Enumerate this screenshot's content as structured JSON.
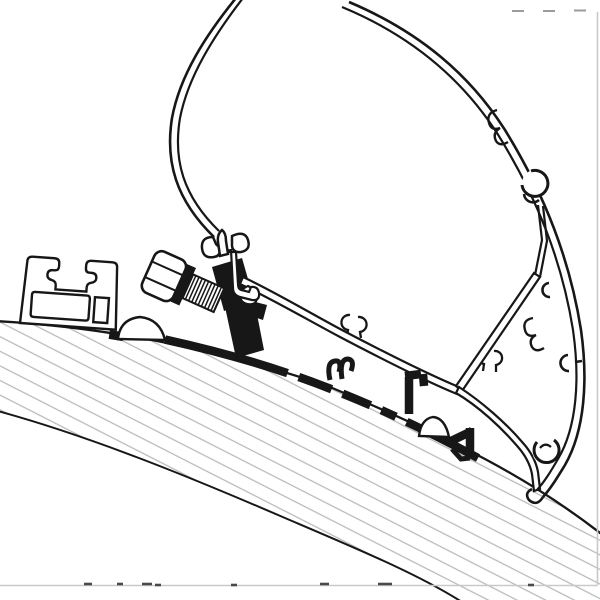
{
  "canvas": {
    "width": 600,
    "height": 600,
    "background": "#ffffff"
  },
  "colors": {
    "paper": "#ffffff",
    "ink": "#171717",
    "hatch": "#b5b9bc",
    "faint": "#c9c9c9",
    "remnant": "#4a4a4a",
    "dash_mark": "#9b9b9b"
  },
  "diagram": {
    "type": "technical-cross-section",
    "parts": [
      {
        "id": "vehicle-roof",
        "style": "hatched-band"
      },
      {
        "id": "rain-gutter-profile",
        "style": "outline"
      },
      {
        "id": "adapter-rail",
        "style": "solid-black"
      },
      {
        "id": "clamp-bracket",
        "style": "solid-black"
      },
      {
        "id": "mounting-bolt",
        "style": "outline"
      },
      {
        "id": "screw-cap-domes",
        "style": "outline"
      },
      {
        "id": "awning-cassette-shell",
        "style": "outline"
      },
      {
        "id": "cassette-bottom-panel",
        "style": "outline"
      }
    ]
  },
  "artifacts": {
    "right_border": {
      "x1": 597.5,
      "y1": 12,
      "x2": 597.5,
      "y2": 585
    },
    "bottom_border": {
      "x1": 0,
      "y1": 585.5,
      "x2": 597.5,
      "y2": 585.5
    },
    "top_dashes": [
      {
        "x1": 512,
        "y1": 11,
        "x2": 524,
        "y2": 11
      },
      {
        "x1": 543,
        "y1": 11,
        "x2": 555,
        "y2": 11
      },
      {
        "x1": 574,
        "y1": 10.5,
        "x2": 586,
        "y2": 10.5
      }
    ],
    "bottom_remnants": [
      {
        "x1": 84,
        "y1": 584,
        "x2": 92,
        "y2": 584
      },
      {
        "x1": 117,
        "y1": 584,
        "x2": 123,
        "y2": 584
      },
      {
        "x1": 142,
        "y1": 584,
        "x2": 152,
        "y2": 584
      },
      {
        "x1": 155,
        "y1": 585,
        "x2": 161,
        "y2": 585
      },
      {
        "x1": 231,
        "y1": 585,
        "x2": 237,
        "y2": 585
      },
      {
        "x1": 320,
        "y1": 584,
        "x2": 329,
        "y2": 584
      },
      {
        "x1": 378,
        "y1": 584,
        "x2": 392,
        "y2": 584
      },
      {
        "x1": 528,
        "y1": 585,
        "x2": 534,
        "y2": 585
      }
    ]
  }
}
